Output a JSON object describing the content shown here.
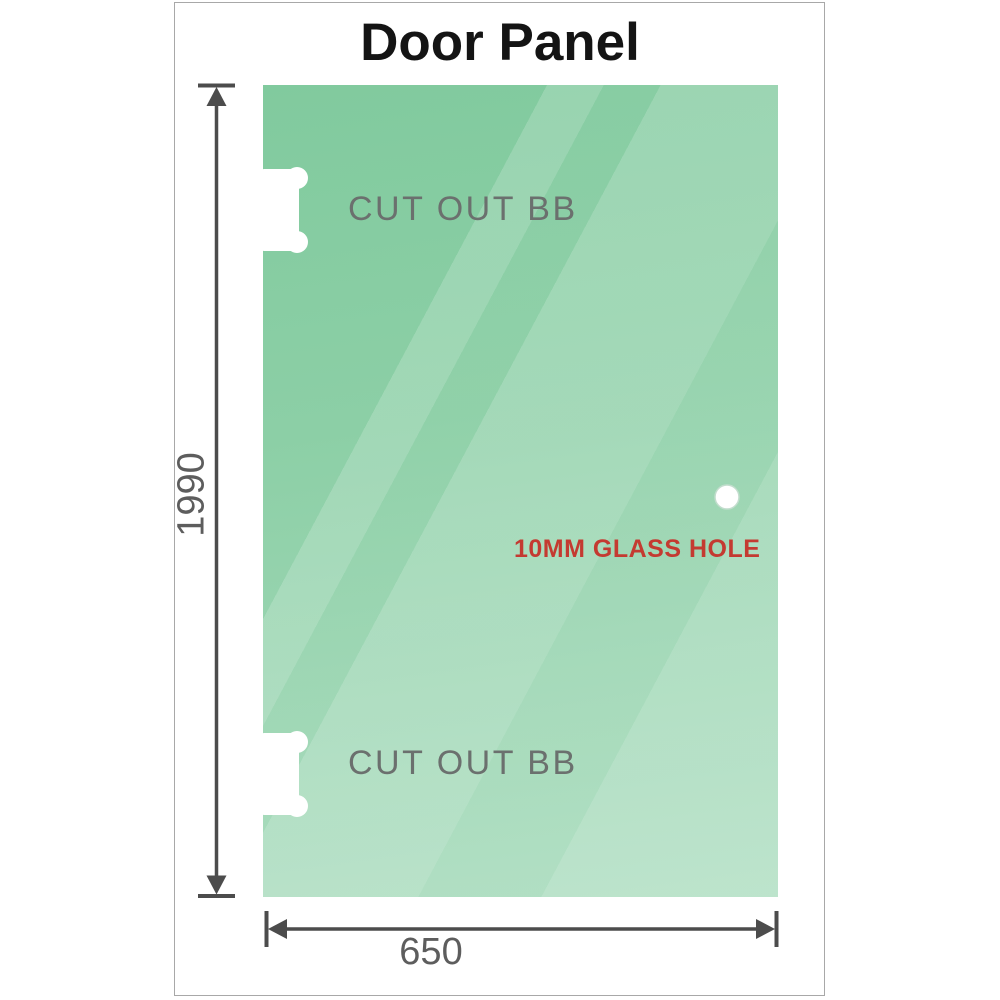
{
  "title": "Door Panel",
  "diagram": {
    "cutouts": [
      {
        "label": "CUT OUT BB",
        "position": "top"
      },
      {
        "label": "CUT OUT BB",
        "position": "bottom"
      }
    ],
    "hole_label": "10MM GLASS HOLE",
    "dimension_height": "1990",
    "dimension_width": "650"
  },
  "theme": {
    "glass_green_top": "#81ca9e",
    "glass_green_mid": "#8ccfa6",
    "glass_green_bottom": "#aadcbe",
    "hole_label_color": "#c43a31",
    "dimension_line_color": "#4c4c4c",
    "label_gray": "#6b706e",
    "dimension_text_gray": "#5d5d5d",
    "title_color": "#141414",
    "frame_border_color": "#a8a8a8"
  }
}
